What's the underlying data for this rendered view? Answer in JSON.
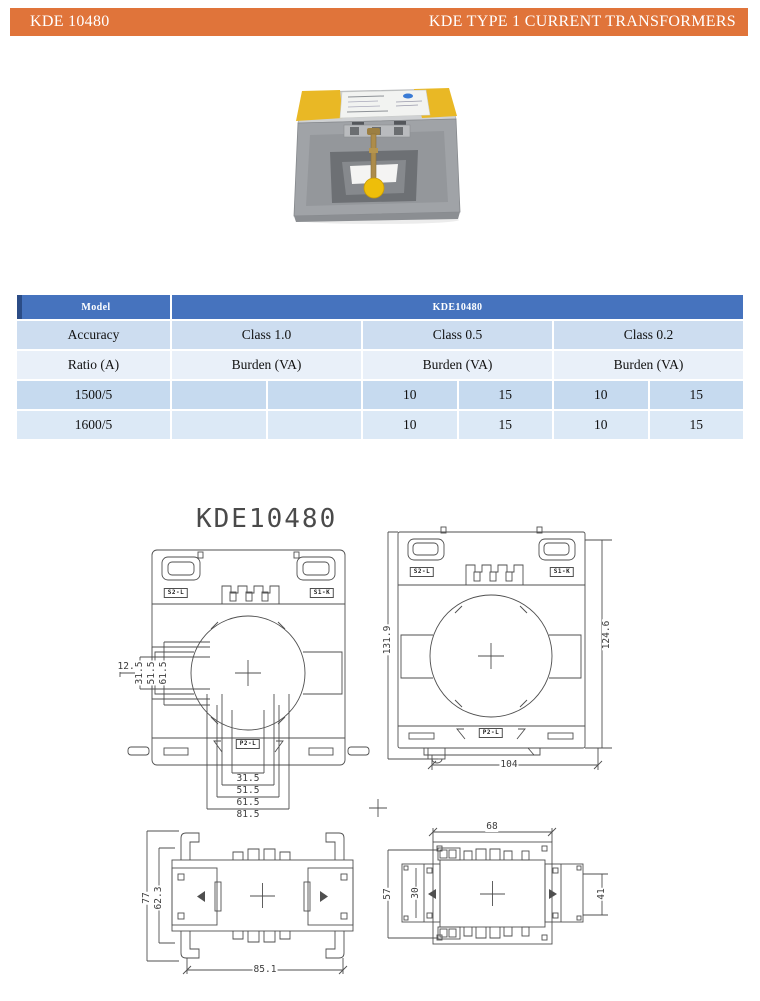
{
  "colors": {
    "accent": "#E0743A",
    "table_header": "#4673BE",
    "table_header_edge": "#2B4C86",
    "row_light_blue": "#CDDDF0",
    "row_pale_blue": "#E9F0F9",
    "row_mid_blue": "#C6DAEF",
    "row_soft_blue": "#DCE9F6",
    "drawing_line": "#4f4f4f"
  },
  "header": {
    "doc_code": "KDE 10480",
    "doc_title": "KDE TYPE 1 CURRENT TRANSFORMERS"
  },
  "spec_table": {
    "model_label": "Model",
    "model_value": "KDE10480",
    "accuracy_label": "Accuracy",
    "class_labels": [
      "Class 1.0",
      "Class 0.5",
      "Class 0.2"
    ],
    "ratio_label": "Ratio (A)",
    "burden_labels": [
      "Burden (VA)",
      "Burden (VA)",
      "Burden (VA)"
    ],
    "rows": [
      {
        "ratio": "1500/5",
        "values": [
          "",
          "",
          "10",
          "15",
          "10",
          "15"
        ]
      },
      {
        "ratio": "1600/5",
        "values": [
          "",
          "",
          "10",
          "15",
          "10",
          "15"
        ]
      }
    ]
  },
  "drawings": {
    "title": "KDE10480",
    "front_view": {
      "terminal_left": "S2-L",
      "terminal_right": "S1-K",
      "terminal_bottom": "P2-L",
      "dim_offset": "12.5",
      "dims_left": [
        "31.5",
        "51.5",
        "61.5"
      ],
      "dims_bottom": [
        "31.5",
        "51.5",
        "61.5",
        "81.5"
      ]
    },
    "rail_view": {
      "terminal_left": "S2-L",
      "terminal_right": "S1-K",
      "terminal_bottom": "P2-L",
      "dim_left": "131.9",
      "dim_right": "124.6",
      "dim_bottom": "104"
    },
    "top_view": {
      "dim_outer": "77",
      "dim_inner": "62.3",
      "dim_bottom": "85.1"
    },
    "top_view_rail": {
      "dim_top": "68",
      "dim_outer_left": "57",
      "dim_inner_left": "30",
      "dim_right": "41"
    }
  }
}
